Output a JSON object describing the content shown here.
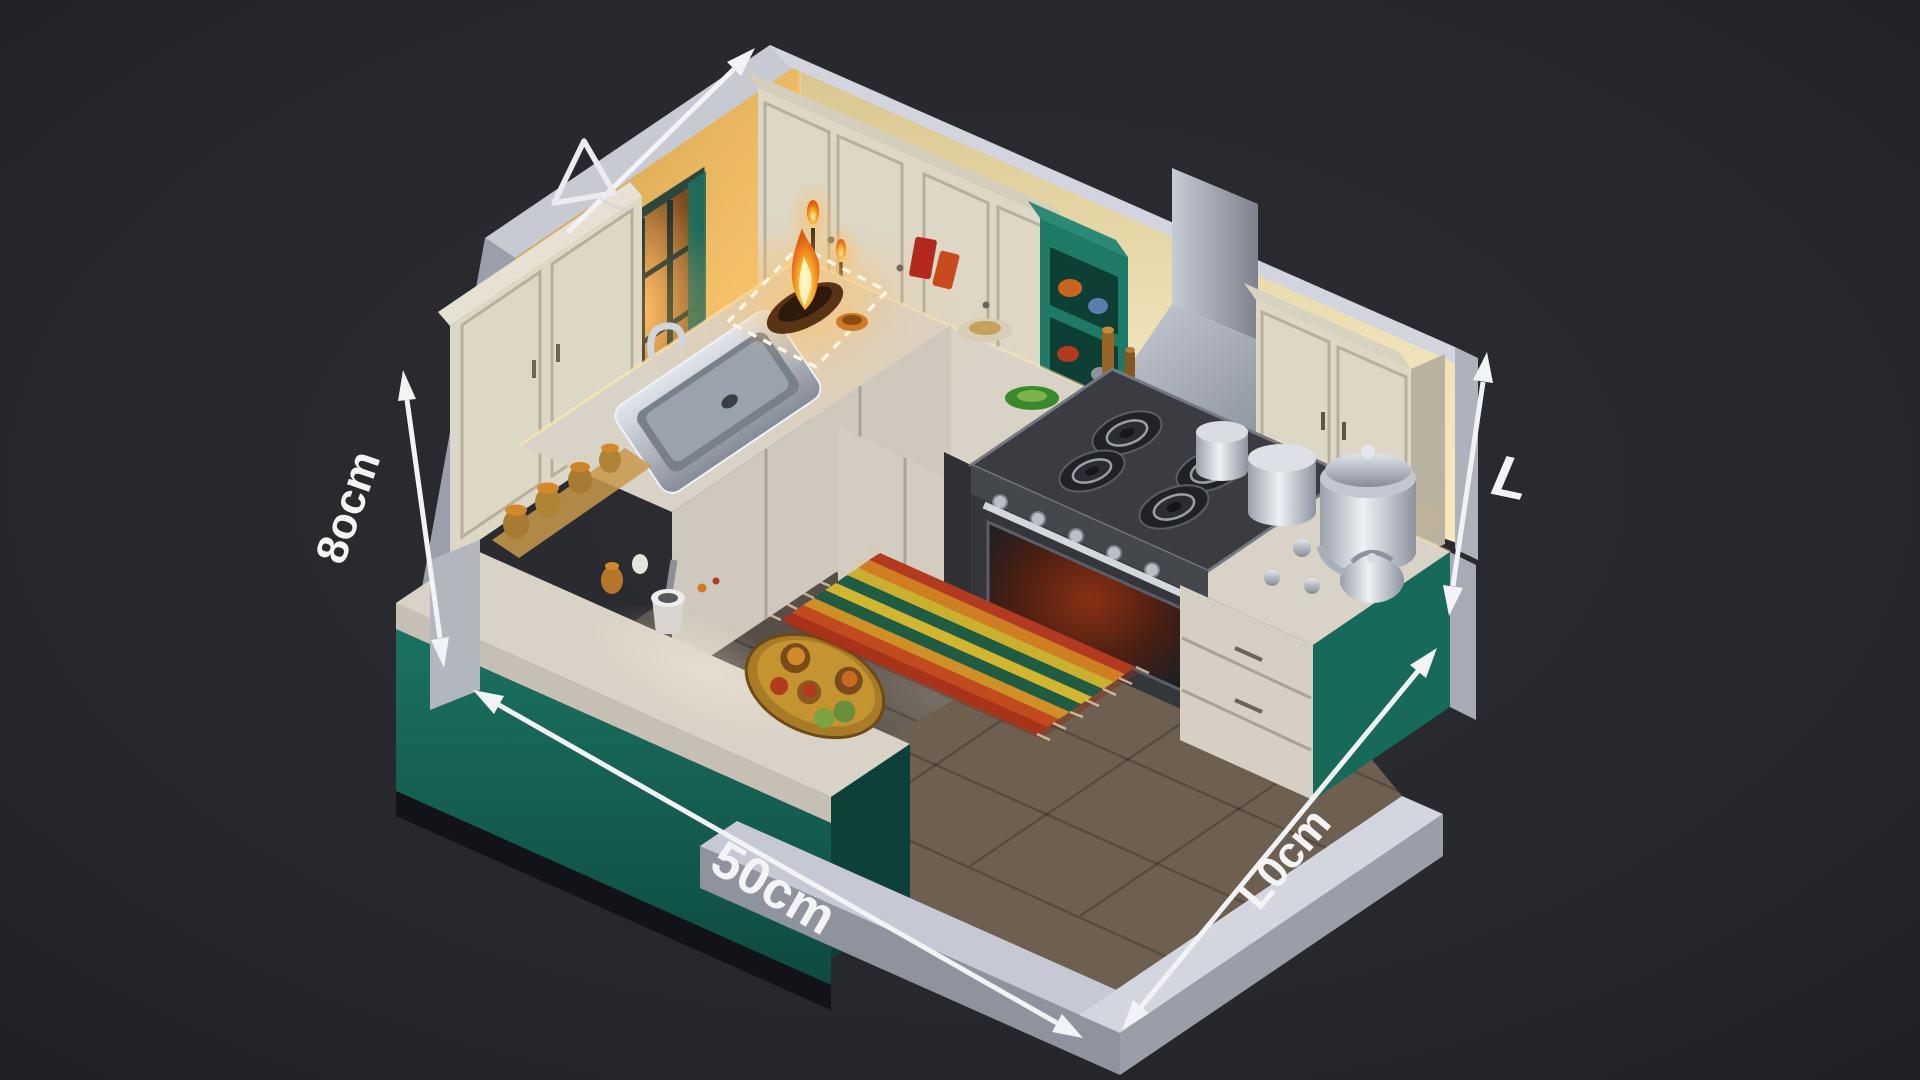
{
  "scene_type": "isometric-kitchen-3d-render-with-dimensions",
  "dimensions": {
    "left": {
      "label": "8ocm"
    },
    "bottom_left": {
      "label": "50cm"
    },
    "bottom_right": {
      "label": "L0cm"
    },
    "right": {
      "label": "L"
    }
  },
  "palette": {
    "background": "#26272b",
    "arrow": "#f2f3f5",
    "wall_warm": "#e7b55c",
    "wall_pale": "#efe2b8",
    "coping_gray": "#c7cad3",
    "outer_wall": "#9aa0ab",
    "cabinet_cream": "#ddd7c5",
    "cabinet_teal": "#176a5a",
    "counter_marble": "#d9d2c6",
    "floor_dark": "#554f48",
    "floor_brown": "#6e6050",
    "low_wall": "#c6c9d3",
    "steel": "#b3b9c2",
    "flame_orange": "#f29a1f"
  },
  "rug": {
    "stripes": [
      "#b23a20",
      "#cf7f22",
      "#c9b02d",
      "#1f5c44",
      "#d2b62e",
      "#1f5c44",
      "#cf9026",
      "#c14a1e",
      "#a93318"
    ]
  },
  "inventory": [
    "window",
    "kitchen-sink",
    "diya-flame",
    "gas-cooktop-4-burner",
    "oven",
    "range-hood",
    "open-shelf-unit",
    "wall-cabinets",
    "spice-jars",
    "steel-pots",
    "kettle",
    "striped-rug",
    "thali-plate",
    "mortar-and-pestle",
    "peninsula-counter",
    "low-boundary-wall",
    "candle-lamps"
  ]
}
